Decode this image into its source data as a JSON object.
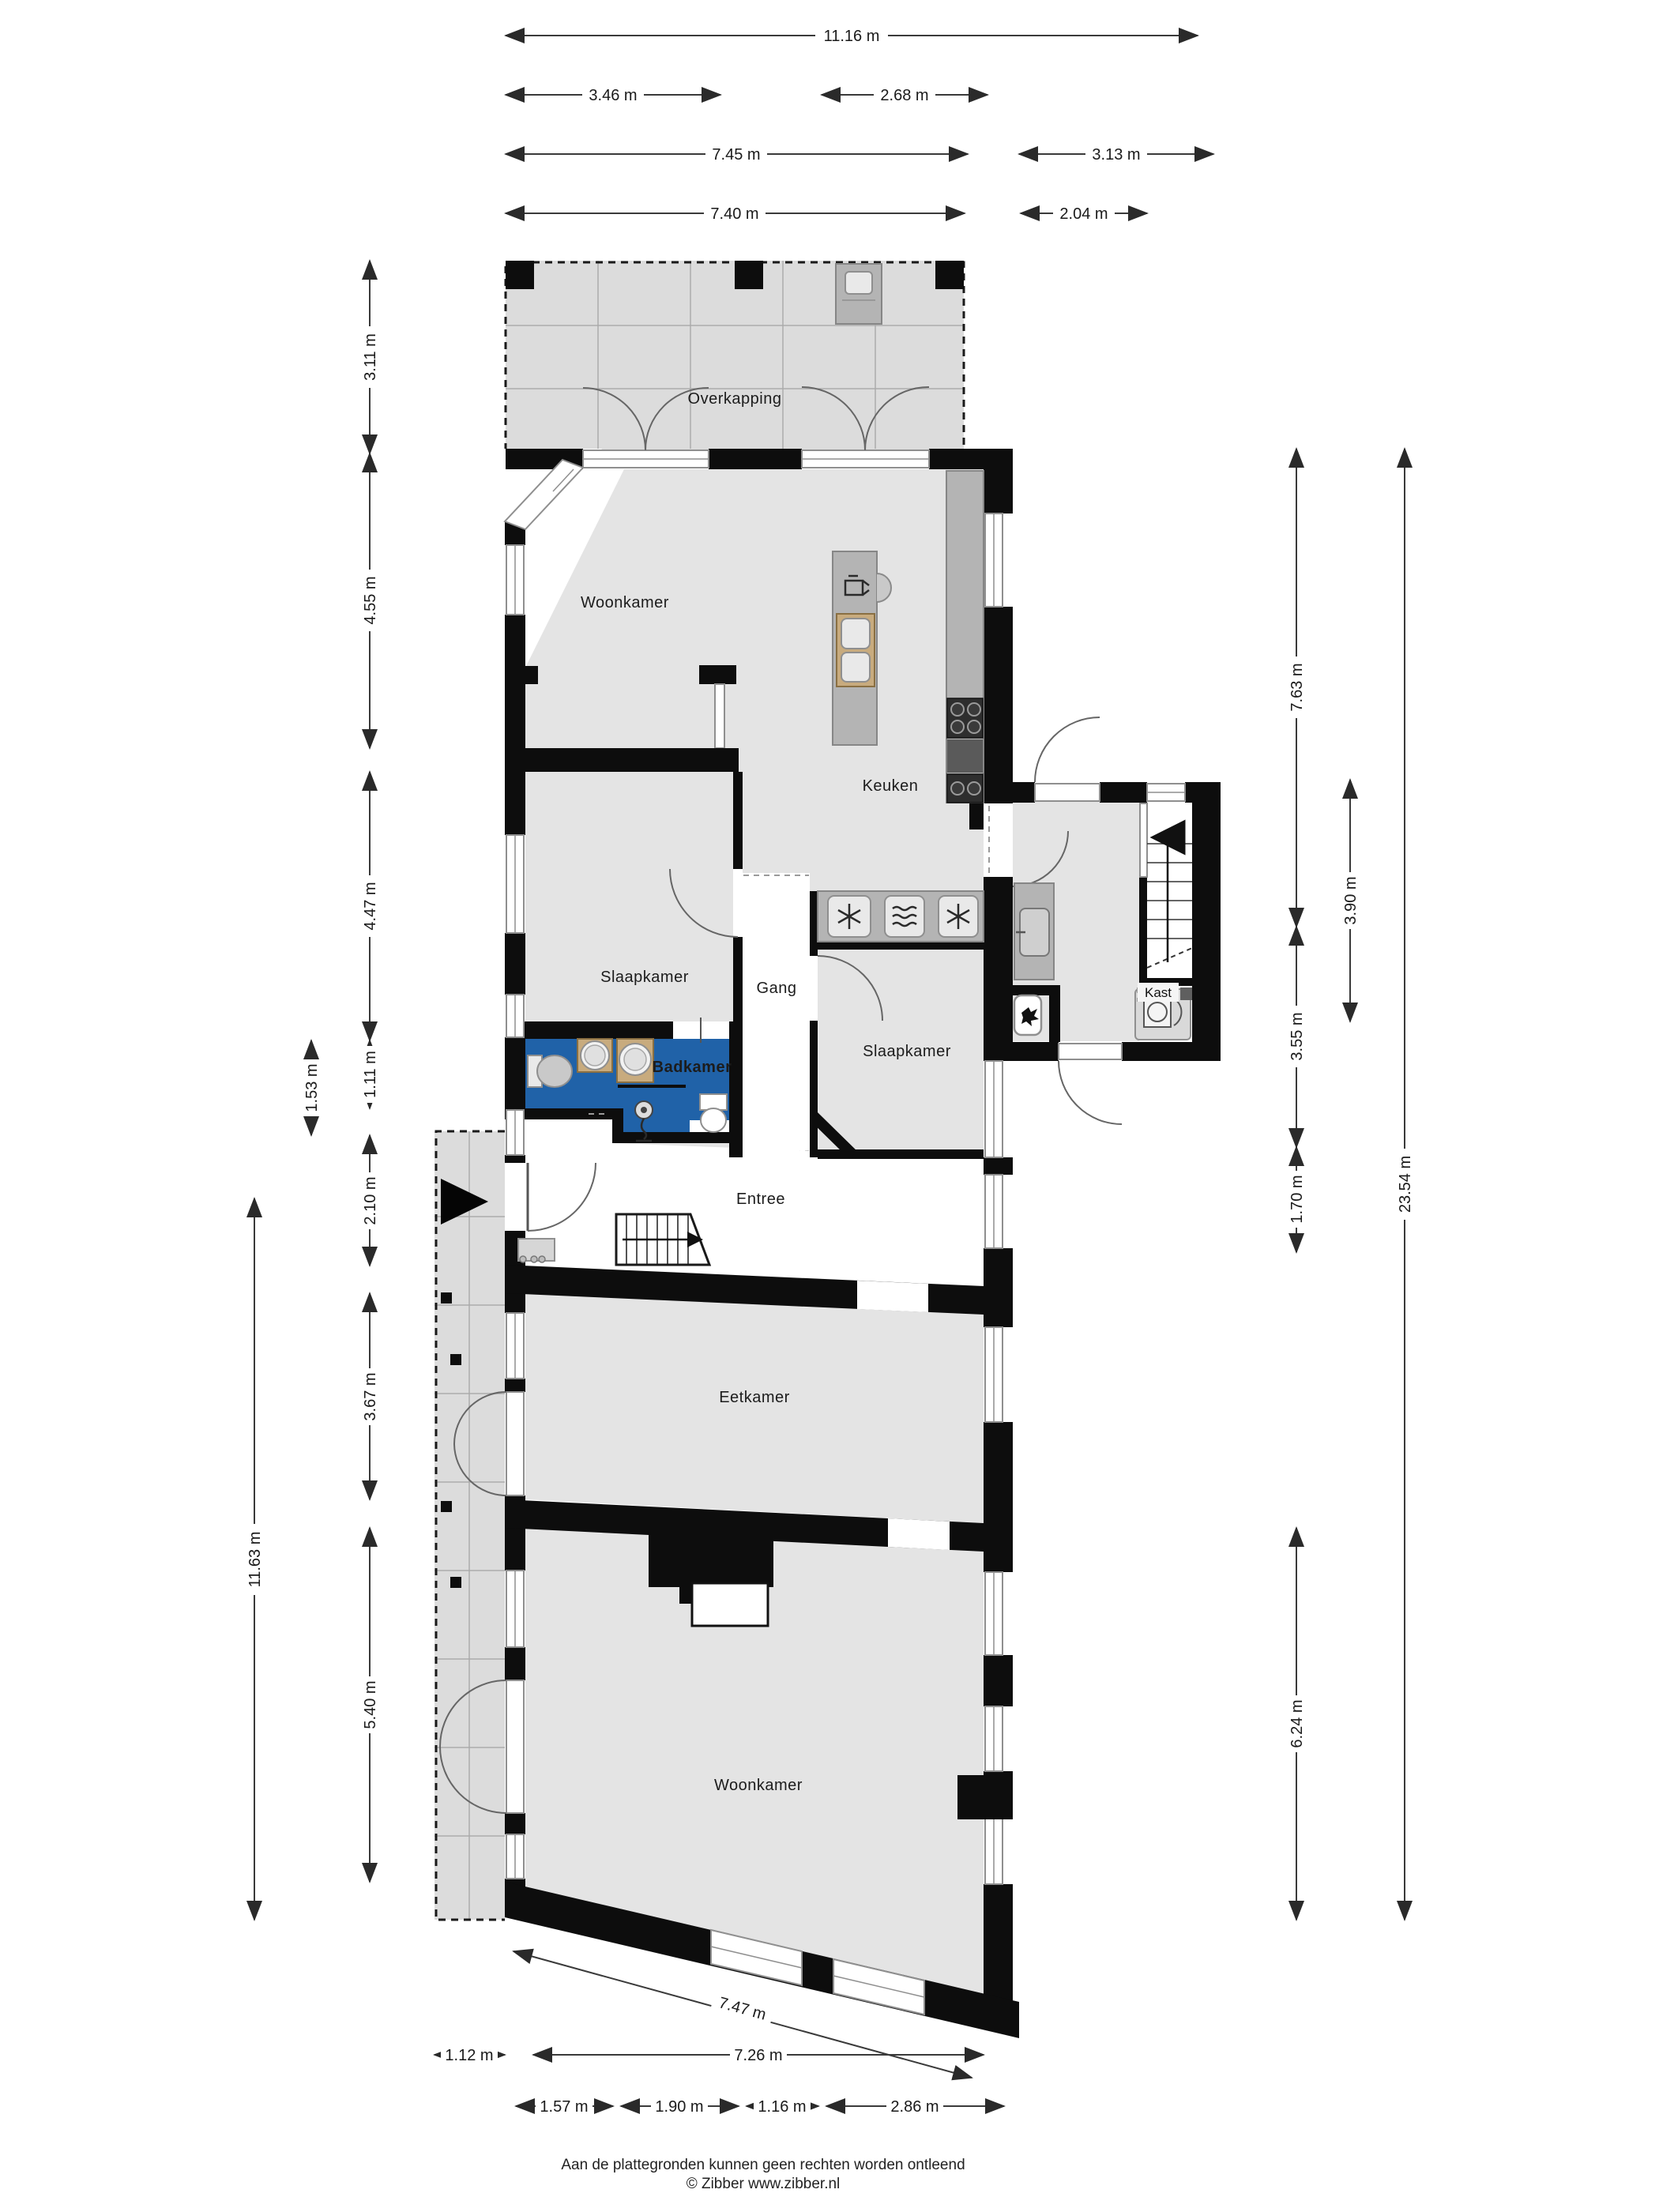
{
  "plan_title": "Begane grond plattegrond",
  "rooms": {
    "overkapping": "Overkapping",
    "woonkamer_top": "Woonkamer",
    "keuken": "Keuken",
    "slaapkamer_left": "Slaapkamer",
    "gang": "Gang",
    "slaapkamer_right": "Slaapkamer",
    "badkamer": "Badkamer",
    "kast": "Kast",
    "entree": "Entree",
    "eetkamer": "Eetkamer",
    "woonkamer_bottom": "Woonkamer"
  },
  "dims": {
    "top": [
      {
        "label": "11.16 m"
      },
      {
        "label": "3.46 m"
      },
      {
        "label": "2.68 m"
      },
      {
        "label": "7.45 m"
      },
      {
        "label": "3.13 m"
      },
      {
        "label": "7.40 m"
      },
      {
        "label": "2.04 m"
      }
    ],
    "left": [
      {
        "label": "3.11 m"
      },
      {
        "label": "4.55 m"
      },
      {
        "label": "4.47 m"
      },
      {
        "label": "1.11 m"
      },
      {
        "label": "1.53 m"
      },
      {
        "label": "2.10 m"
      },
      {
        "label": "3.67 m"
      },
      {
        "label": "5.40 m"
      },
      {
        "label": "11.63 m"
      }
    ],
    "right": [
      {
        "label": "7.63 m"
      },
      {
        "label": "3.55 m"
      },
      {
        "label": "1.70 m"
      },
      {
        "label": "6.24 m"
      },
      {
        "label": "3.90 m"
      },
      {
        "label": "23.54 m"
      }
    ],
    "bottom": [
      {
        "label": "7.47 m"
      },
      {
        "label": "1.12 m"
      },
      {
        "label": "7.26 m"
      },
      {
        "label": "1.57 m"
      },
      {
        "label": "1.90 m"
      },
      {
        "label": "1.16 m"
      },
      {
        "label": "2.86 m"
      }
    ]
  },
  "footer": {
    "line1": "Aan de plattegronden kunnen geen rechten worden ontleend",
    "line2": "© Zibber www.zibber.nl"
  },
  "colors": {
    "bathroom_blue": "#2062a8",
    "wall_black": "#0d0d0d",
    "floor_gray": "#e4e4e4",
    "terrace_gray": "#dcdcdc",
    "counter_gray": "#b4b4b4",
    "wood_tan": "#c8ab7e"
  },
  "icons": {
    "entrance-arrow": "right-filled-triangle",
    "stairs-up-arrow": "up-filled-triangle",
    "washing-machine": "6-spoke-star",
    "dryer": "6-spoke-star",
    "oven": "waves-in-rounded-square",
    "hob": "4-burner-circles",
    "sink": "rounded-square-basin",
    "shower": "shower-head",
    "toilet": "bowl-top-view"
  }
}
